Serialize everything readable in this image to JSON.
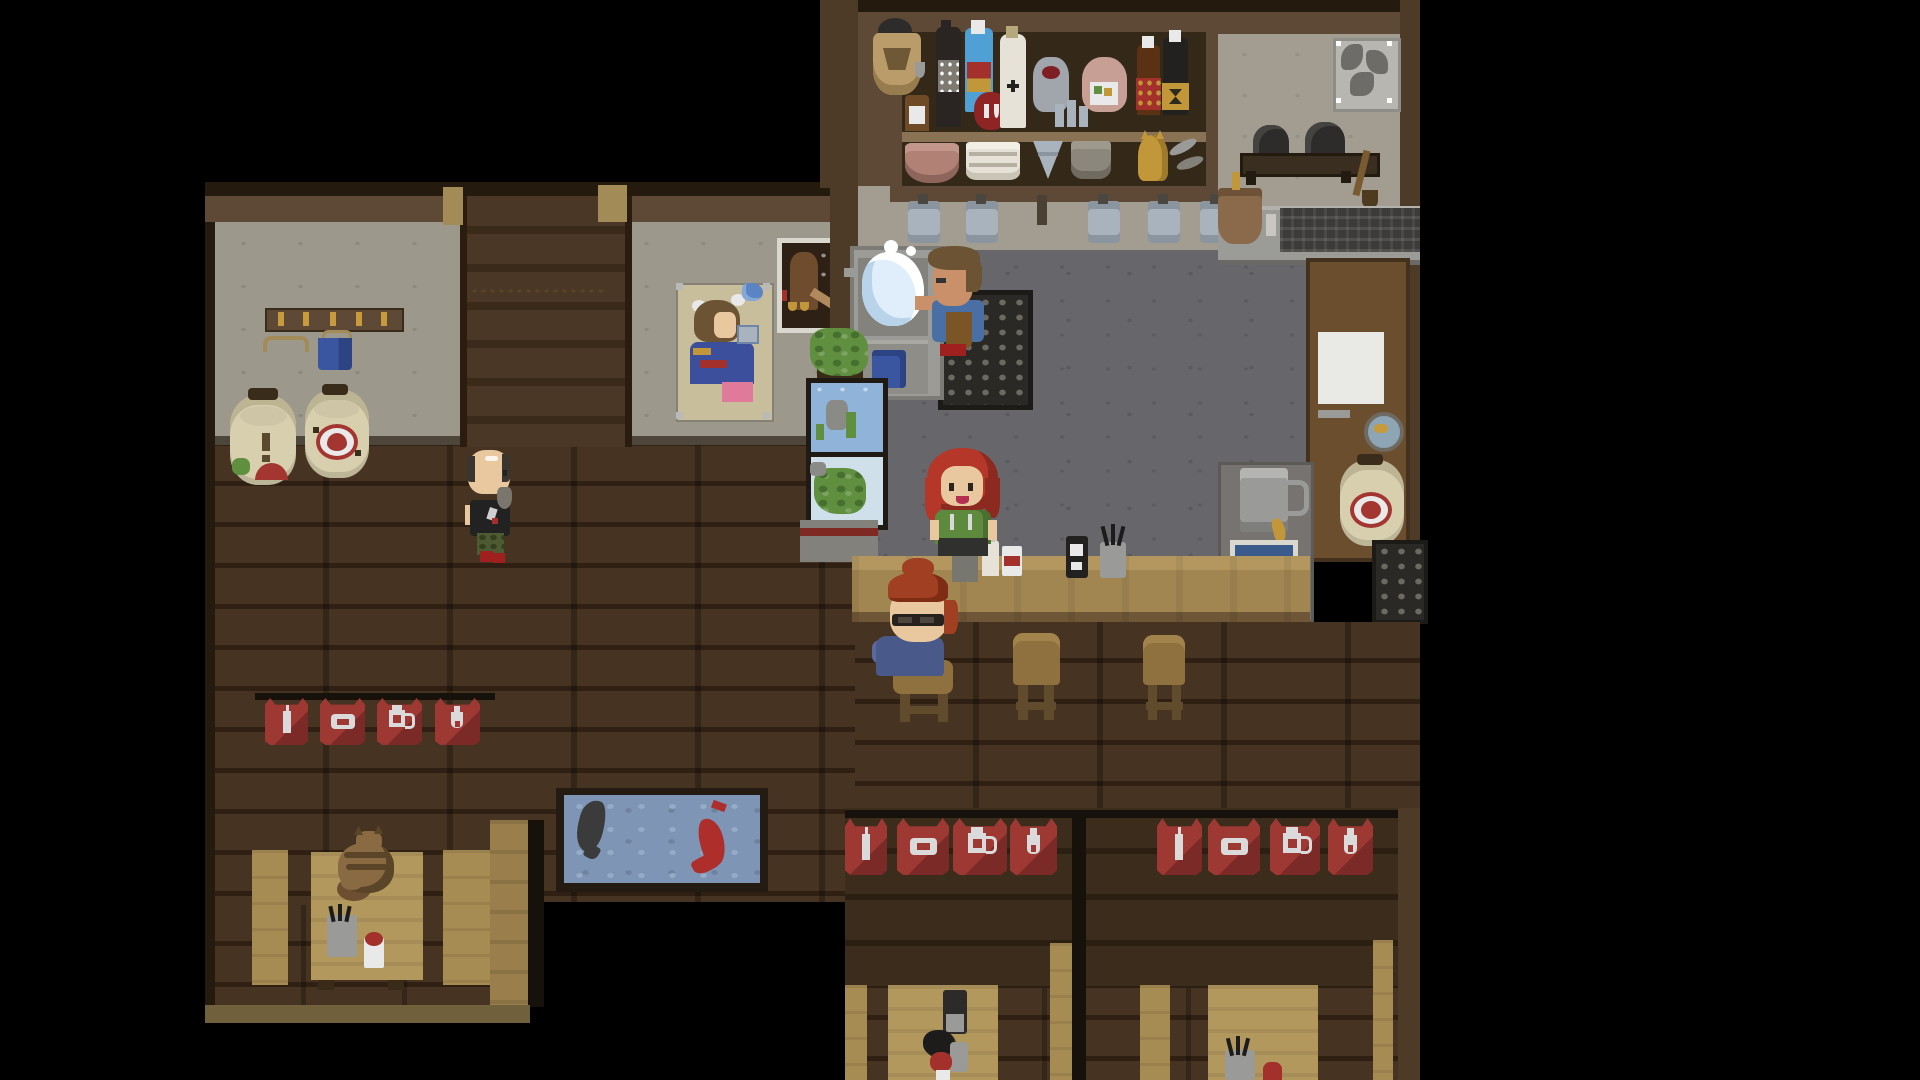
{
  "scene": {
    "title": "Top-down pixel-art izakaya tavern interior",
    "style": "2D pixel RPG, night tavern scene"
  },
  "palette": {
    "black": "#000000",
    "beam": "#241a0e",
    "brownBand": "#5d4936",
    "woodWall": "#4e3b27",
    "wallGrey": "#9d988c",
    "wallGreen": "#a29d90",
    "floor": "#463321",
    "floorGap": "#2f2013",
    "floorLight": "#5a4429",
    "stair": "#4a3726",
    "stairDark": "#392a19",
    "newel": "#a38b58",
    "shelfFrame": "#8a7354",
    "shelfWood": "#5e4936",
    "shelfDark": "#342819",
    "counterTop": "#a18651",
    "counterHi": "#b3975f",
    "counterEdge": "#6e5636",
    "kFloor": "#67666b",
    "kFloorDark": "#5c5b60",
    "steel": "#9b9b97",
    "steelDark": "#77766f",
    "crate": "#2b2926",
    "crateDot": "#6c6963",
    "stool": "#8f713f",
    "stoolDark": "#604b2d",
    "bannerRed": "#9e3833",
    "bannerDark": "#7c2a27",
    "railDark": "#16110b",
    "iconWhite": "#dadada",
    "pondWater": "#7e95b5",
    "pondLight": "#95abc7",
    "pondFrame": "#241c12",
    "koiRed": "#ae2e2c",
    "koiBlack": "#3b3b3b",
    "tableTan": "#b3985e",
    "benchTan": "#a68b53",
    "wallTan": "#9a7f4c",
    "bottomWall": "#70603c",
    "lantern": "#d8cfae",
    "lanternShade": "#bdb494",
    "lanternCap": "#3a2c1a",
    "emblemRed": "#a33630",
    "doorBrown": "#6b4e2e",
    "doorDark": "#44311d",
    "windowWhite": "#e9e9e5",
    "cabinetGrey": "#767370",
    "mugBlue": "#a9b3bd",
    "mugBlueDark": "#8b959f",
    "skin": "#e9c8a0",
    "skinTan": "#c9906a",
    "hairRed": "#b5372a",
    "hairRedDark": "#8c2a1f",
    "hairAuburn": "#a03f22",
    "hairBrown": "#6b5334",
    "shirtGreen": "#5d8a3c",
    "shirtGreenDk": "#49702e",
    "shirtBlue": "#4a6fa5",
    "shirtNavy": "#49598a",
    "apronDark": "#30302f",
    "apronBrown": "#7c5527",
    "teeBlack": "#222222",
    "camo": "#4d5a32",
    "shoeRed": "#a02020",
    "catBody": "#8a6a42",
    "catDark": "#5b4528",
    "plantGreen": "#5f8f3f",
    "plantDark": "#477030",
    "aquaWater": "#8fb3d9",
    "terraBg": "#cfe0ea",
    "posterBeige": "#c8be9c",
    "posterInk": "#2e2014",
    "posterFrame": "#dad7ce",
    "posterBrown": "#6f4c2e",
    "gold": "#c79b3b",
    "pinkJar": "#c79f95",
    "white": "#e9e9e9",
    "greyMid": "#9a9a98",
    "blueCloth": "#3a56a0",
    "copper": "#8a6a4a",
    "vent": "#b8b6b1",
    "ventBlade": "#6e6c68",
    "bottleDark": "#2a2522",
    "labelRed": "#a3302a",
    "labelGold": "#c2973a",
    "sake": "#e6e2d8",
    "jugGrey": "#a0a6ac",
    "stripeRed": "#7e2a22",
    "grill": "#3d3b39",
    "potBlack": "#2e2c2a",
    "splash": "#dfeefa",
    "wbA": "#3b2c1c",
    "wbB": "#2b1f12"
  },
  "entities": {
    "leftRoom": "Tavern hall with wooden floor",
    "kitchen": "Kitchen and bar area",
    "stairs": "Staircase to upper floor",
    "coatRack": "Coat rack with hanger and blue jacket",
    "lanternLeft1": "Paper lantern with red mouth design",
    "lanternLeft2": "Paper lantern with flower emblem",
    "lanternRight": "Paper lantern beside back door",
    "posterPinup": "Poster of woman drinking",
    "posterAd": "Dark advertisement poster",
    "shelf": "Bar back-shelf with bottles and dishes",
    "basket": "Hanging basket with black pot",
    "ventFan": "Ventilation fan",
    "potRack": "Rack with hanging pots and broom",
    "stove": "Stove counter with grill and copper pot",
    "sink": "Sink with running water",
    "chef": "Chef washing dishes",
    "crate": "Dish drying crate",
    "bartender": "Red-haired bartender",
    "barCounter": "Bar counter",
    "customerBar": "Seated customer with glasses",
    "stool": "Bar stool",
    "walker": "Bald patron with beard walking",
    "terrarium": "Stacked planters and aquarium",
    "door": "Back door with frosted window",
    "mugCabinet": "Cabinet with beer stein and photo",
    "bannerRow": "Red noren banners: bottle, bowl, mug, flask",
    "pond": "Indoor koi pond with red and black koi",
    "catTable": "Booth table with sleeping cat",
    "cat": "Sleeping tabby cat",
    "boothCenter": "Center booth with dining patron",
    "boothRight": "Right booth table",
    "patronBooth": "Patron dining at booth",
    "counterItems": "Drinks and utensil cups on the counter"
  }
}
